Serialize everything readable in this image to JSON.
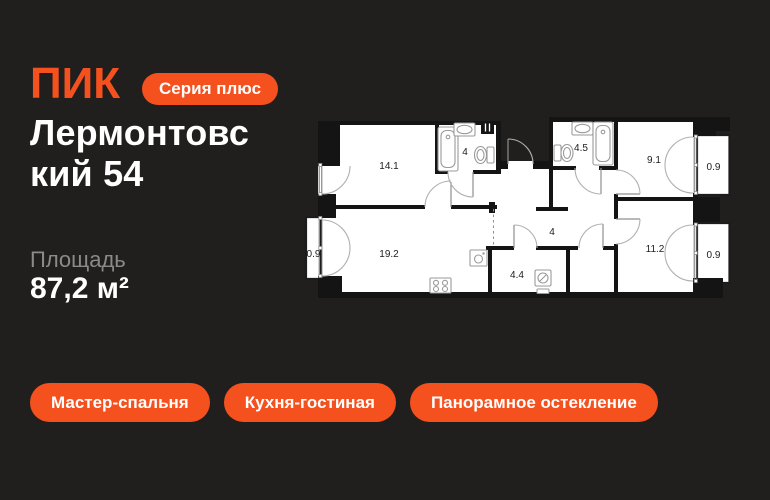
{
  "brand": {
    "logo_text": "ПИК",
    "badge": "Серия плюс"
  },
  "title": {
    "full": "Лермонтовский 54",
    "line1": "Лермонтовс",
    "line2": "кий 54"
  },
  "area": {
    "label": "Площадь",
    "value": "87,2 м²"
  },
  "tags": [
    {
      "label": "Мастер-спальня"
    },
    {
      "label": "Кухня-гостиная"
    },
    {
      "label": "Панорамное остекление"
    }
  ],
  "floorplan": {
    "rooms": {
      "bedroom": "14.1",
      "bathroom_small": "4",
      "bathroom_large": "4.5",
      "bedroom_2": "9.1",
      "balcony_top_right": "0.9",
      "hallway": "4",
      "balcony_left": "0.9",
      "kitchen_living": "19.2",
      "storage": "4.4",
      "bedroom_3": "11.2",
      "balcony_bottom_right": "0.9"
    }
  },
  "colors": {
    "accent": "#F4511E",
    "background": "#211F1E",
    "muted_text": "#8C8A86",
    "plan_wall": "#141414"
  }
}
